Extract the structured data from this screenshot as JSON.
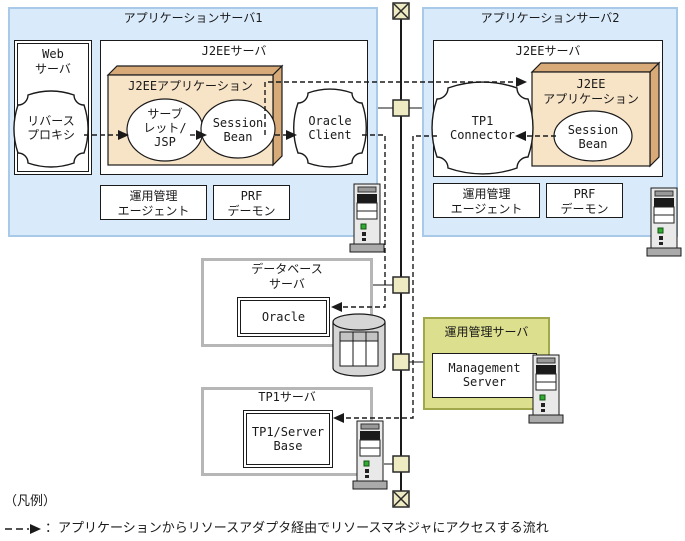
{
  "app_server1": {
    "title": "アプリケーションサーバ1",
    "web_server": {
      "title": "Web\nサーバ",
      "reverse_proxy": "リバース\nプロキシ"
    },
    "j2ee_server": {
      "title": "J2EEサーバ",
      "j2ee_app": {
        "title": "J2EEアプリケーション",
        "servlet": "サーブ\nレット/\nJSP",
        "session_bean": "Session\nBean"
      },
      "oracle_client": "Oracle\nClient"
    },
    "agent": "運用管理\nエージェント",
    "prf": "PRF\nデーモン"
  },
  "app_server2": {
    "title": "アプリケーションサーバ2",
    "j2ee_server": {
      "title": "J2EEサーバ",
      "tp1_connector": "TP1\nConnector",
      "j2ee_app": {
        "title": "J2EE\nアプリケーション",
        "session_bean": "Session\nBean"
      }
    },
    "agent": "運用管理\nエージェント",
    "prf": "PRF\nデーモン"
  },
  "db_server": {
    "title": "データベース\nサーバ",
    "product": "Oracle"
  },
  "tp1_server": {
    "title": "TP1サーバ",
    "product": "TP1/Server\nBase"
  },
  "mgmt_server": {
    "title": "運用管理サーバ",
    "product": "Management\nServer"
  },
  "legend": {
    "heading": "（凡例）",
    "text": "：アプリケーションからリソースアダプタ経由でリソースマネジャにアクセスする流れ"
  },
  "icons": {
    "server_tower": "tower-server",
    "database": "cylinder-with-table",
    "network_terminator": "crossed-box",
    "network_node": "small-square-node",
    "flow_arrow": "dashed-arrow"
  },
  "colors": {
    "blue_fill": "#d9eafb",
    "blue_border": "#a9c9e8",
    "beige": "#f7e3c6",
    "tan": "#d7aa78",
    "gray_border": "#b6b6b6",
    "green_fill": "#dcdf8e",
    "green_border": "#a0a84b",
    "node": "#eeeac2",
    "line": "#8a8a8a",
    "ink": "#1a1a1a"
  }
}
